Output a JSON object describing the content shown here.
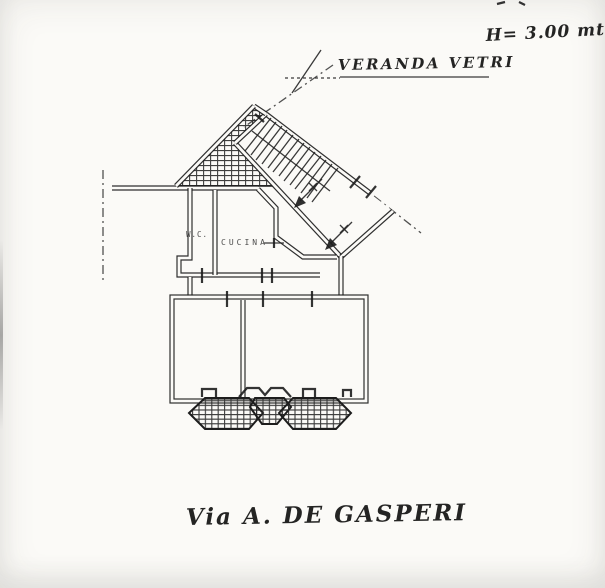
{
  "document": {
    "annotations": {
      "height_note": "H= 3.00 mt.",
      "veranda_label": "VERANDA VETRI",
      "street_label": "Via A. DE GASPERI"
    },
    "room_labels": {
      "wc": "W.C.",
      "kitchen": "CUCINA"
    },
    "colors": {
      "ink": "#1f1f1f",
      "paper": "#fbfaf7",
      "hatch": "#2a2a2a"
    }
  }
}
